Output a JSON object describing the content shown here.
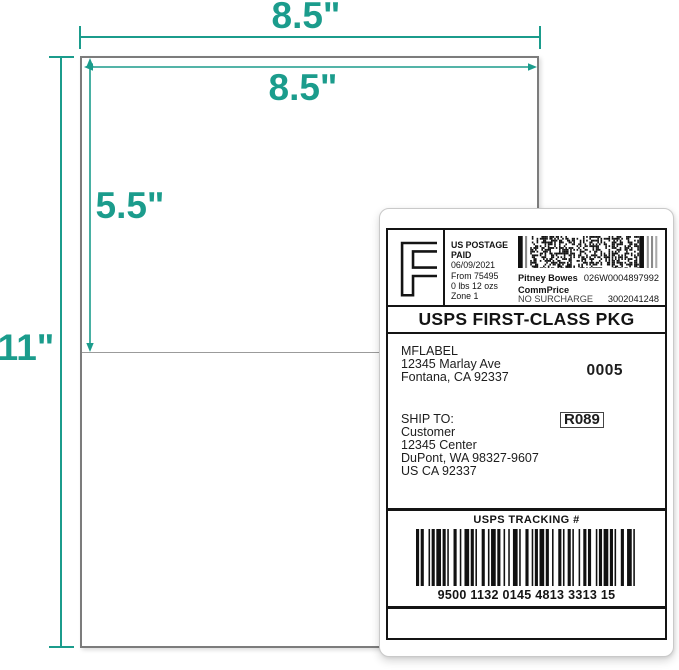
{
  "dimensions": {
    "accent_color": "#1b9c8c",
    "sheet_width": "8.5\"",
    "label_width": "8.5\"",
    "label_height": "5.5\"",
    "sheet_height": "11\""
  },
  "label": {
    "postage": {
      "letter": "F",
      "us_postage": "US POSTAGE",
      "paid": "PAID",
      "date": "06/09/2021",
      "from": "From 75495",
      "weight": "0 lbs 12 ozs",
      "zone": "Zone 1",
      "carrier": "Pitney Bowes",
      "meter_id": "026W0004897992",
      "commprice": "CommPrice",
      "no_surcharge": "NO SURCHARGE",
      "account": "3002041248"
    },
    "service": "USPS FIRST-CLASS PKG",
    "from": {
      "name": "MFLABEL",
      "street": "12345 Marlay Ave",
      "city": "Fontana, CA 92337",
      "batch": "0005"
    },
    "ship_to": {
      "heading": "SHIP TO:",
      "name": "Customer",
      "street": "12345 Center",
      "city": "DuPont, WA 98327-9607",
      "country": "US CA 92337",
      "route_code": "R089"
    },
    "tracking": {
      "heading": "USPS TRACKING #",
      "number": "9500 1132 0145 4813 3313 15"
    }
  }
}
